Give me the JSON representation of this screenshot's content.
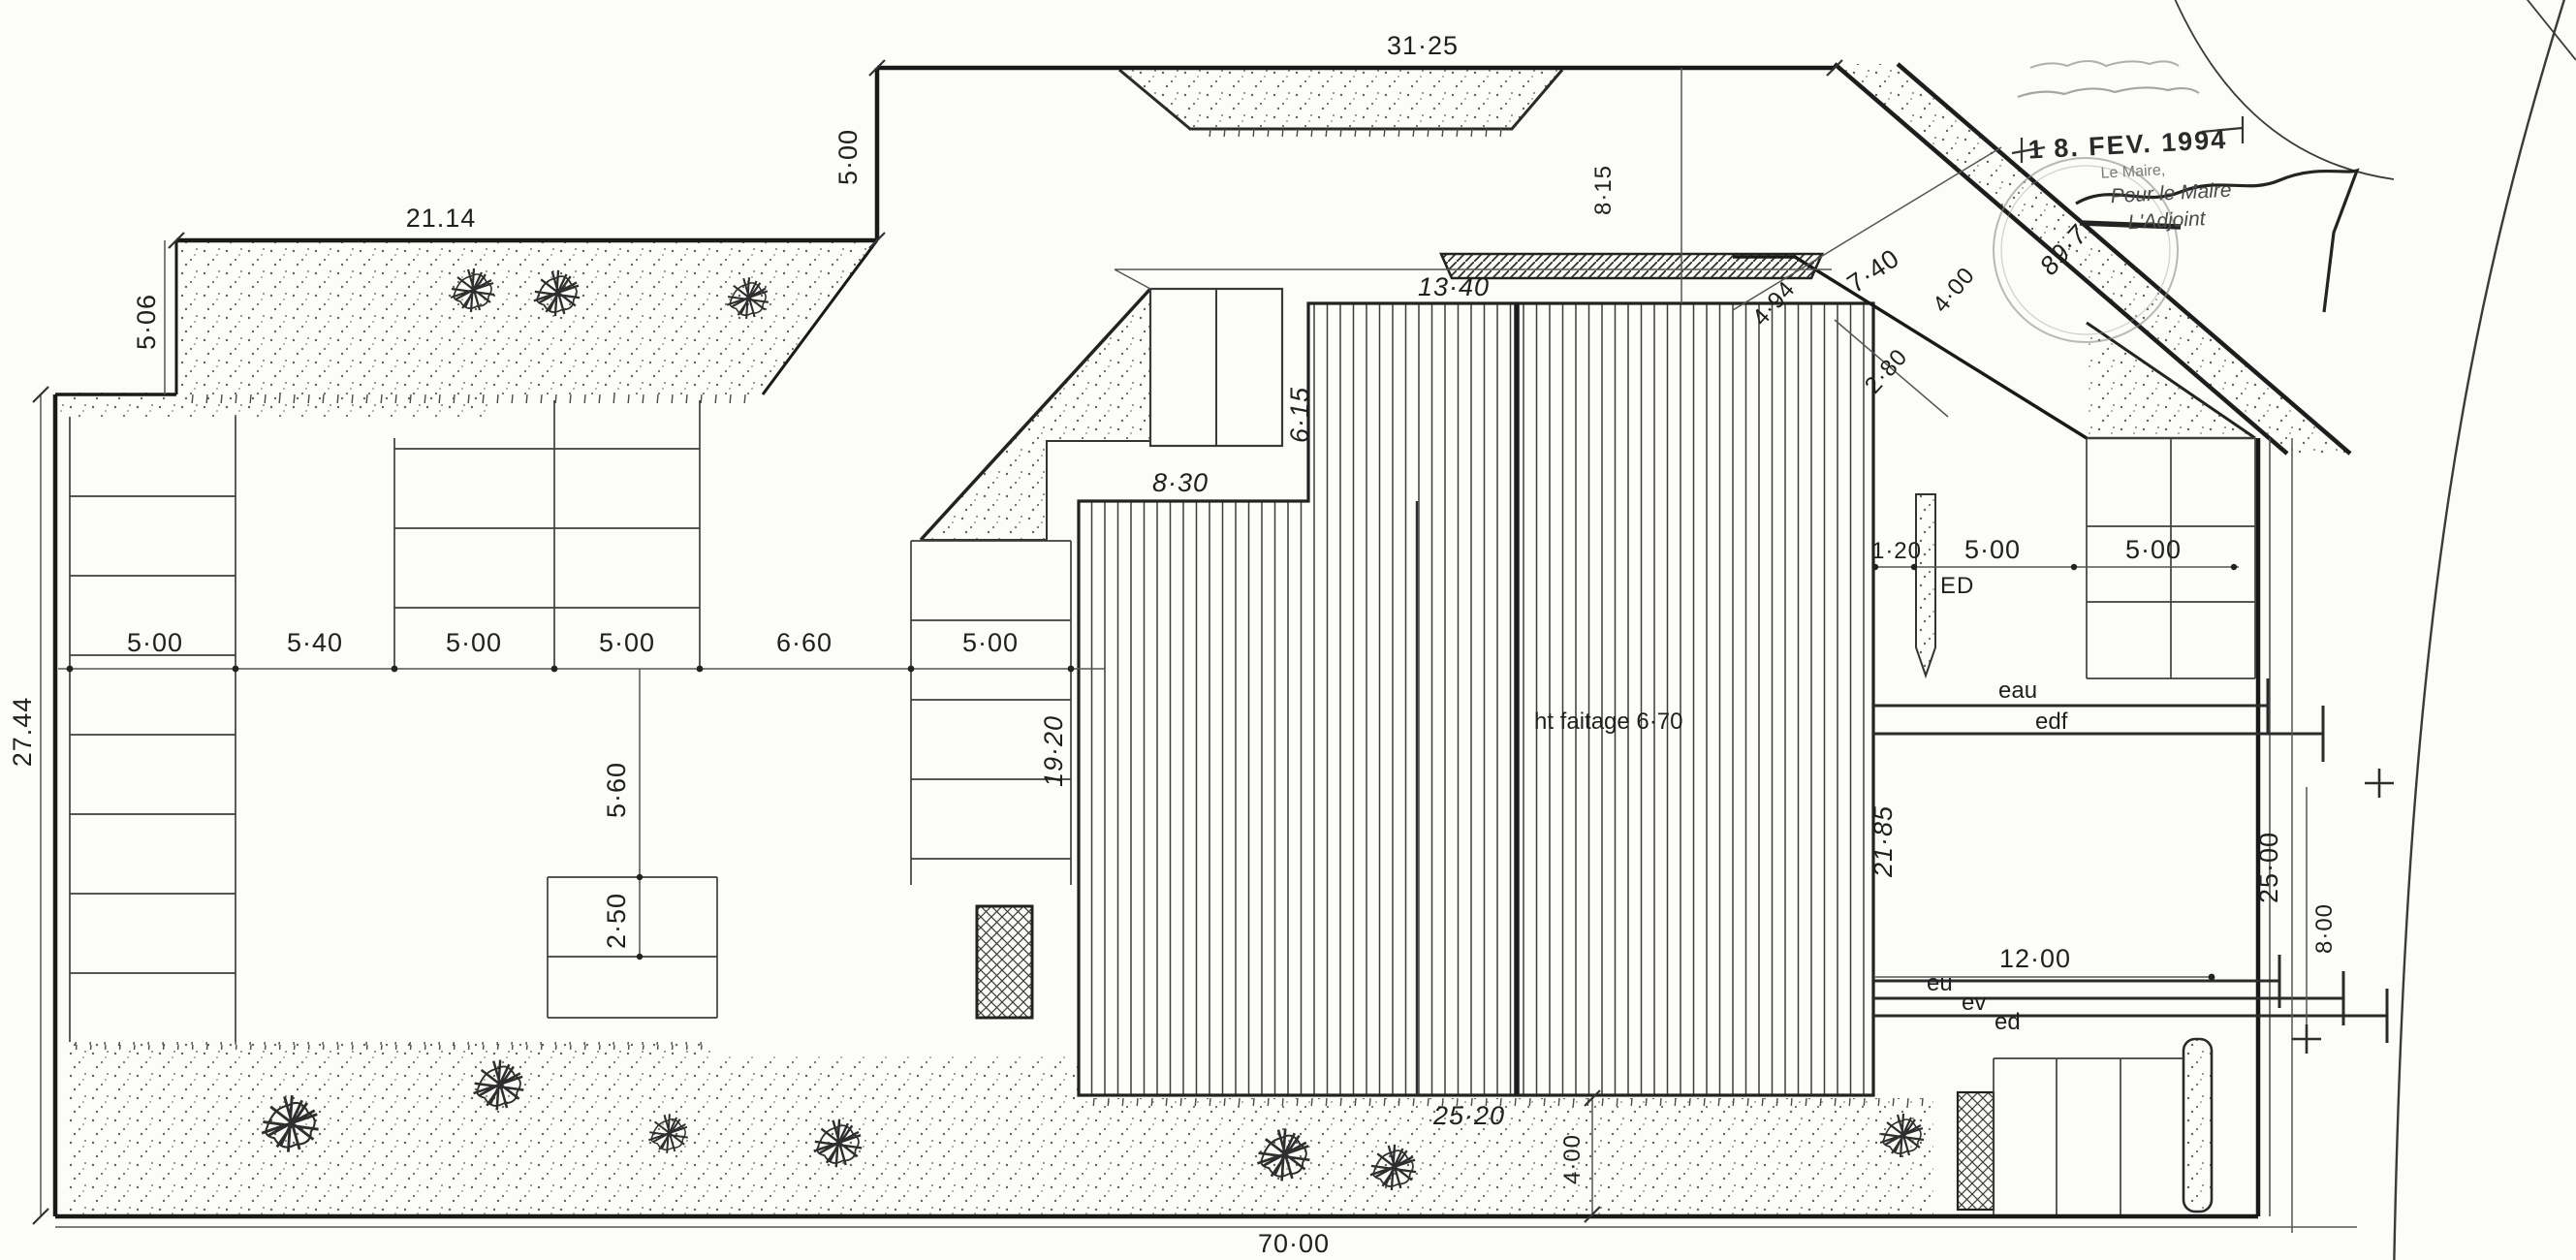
{
  "stamp": {
    "date": "1 8. FEV. 1994",
    "authority": "Le Maire,",
    "for_line": "Pour le Maire",
    "signatory": "L'Adjoint"
  },
  "annotations": {
    "ridge_height": "ht faitage 6·70",
    "ed_marker": "ED",
    "road_level": "89·7"
  },
  "utilities": {
    "water": "eau",
    "electricity": "edf",
    "sewage": "eu",
    "waste": "ev",
    "drain": "ed"
  },
  "dimensions": {
    "top_total": "31·25",
    "top_left_band": "21.14",
    "left_leg": "5·00",
    "left_band_depth": "5·06",
    "left_height": "27.44",
    "row": [
      "5·00",
      "5·40",
      "5·00",
      "5·00",
      "6·60",
      "5·00"
    ],
    "mid_gap": "5·60",
    "stall_depth": "2·50",
    "bldg_top": "13·40",
    "bldg_upper_left": "8·30",
    "bldg_step": "6·15",
    "bldg_left": "19·20",
    "bldg_right": "21·85",
    "bldg_bottom": "25·20",
    "top_offset": "8·15",
    "road_diag_a": "7·40",
    "road_diag_b": "4·00",
    "road_diag_c": "2·80",
    "road_diag_d": "4·94",
    "right_a": "1·20",
    "right_b": "5·00",
    "right_c": "5·00",
    "utility_span": "12·00",
    "right_edge": "25·00",
    "right_offset": "8·00",
    "bottom_strip": "4·00",
    "bottom_total": "70·00"
  }
}
